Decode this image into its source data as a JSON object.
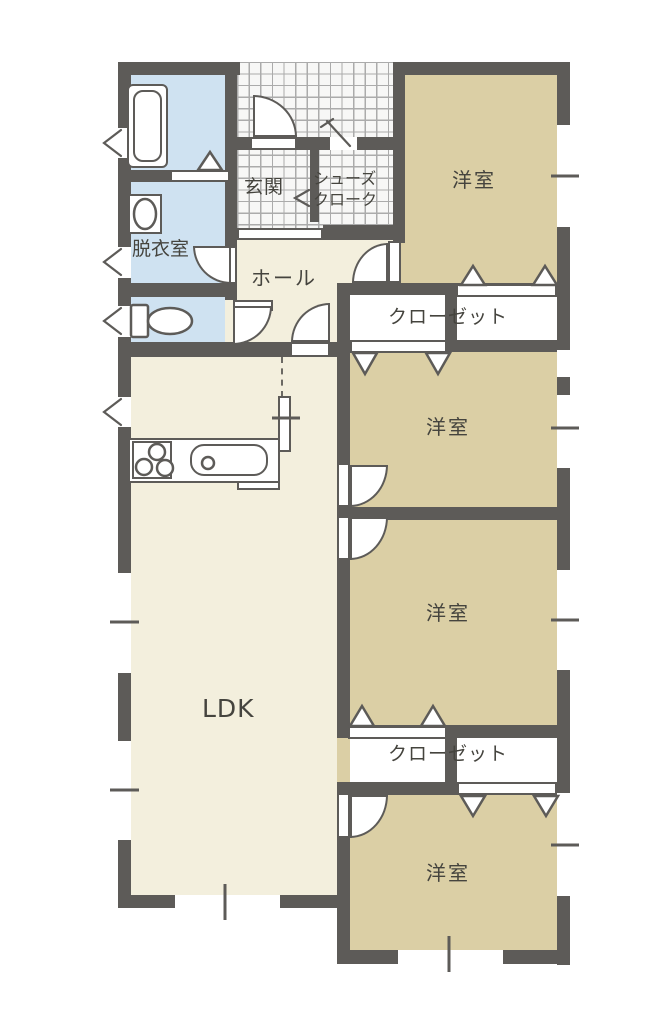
{
  "floorplan": {
    "rooms": {
      "bedroom_top": "洋室",
      "bedroom_mid_upper": "洋室",
      "bedroom_mid_lower": "洋室",
      "bedroom_bottom": "洋室",
      "ldk": "LDK",
      "hall": "ホール",
      "entrance": "玄関",
      "shoe_closet_line1": "シューズ",
      "shoe_closet_line2": "クローク",
      "dressing_room": "脱衣室",
      "closet_upper": "クローゼット",
      "closet_lower": "クローゼット"
    },
    "colors": {
      "wall": "#5d5b58",
      "bedroom_floor": "#dbcfa5",
      "living_floor": "#f3efdd",
      "wet_area_floor": "#cfe2f1",
      "tile_floor": "#f7f7f6",
      "tile_line": "#ababab",
      "text": "#45443e"
    },
    "fixtures": [
      "bathtub-icon",
      "washbasin-icon",
      "toilet-icon",
      "gas-stove-icon",
      "kitchen-sink-icon",
      "door-swing-icon",
      "bifold-door-icon",
      "window-icon",
      "sliding-door-icon",
      "awning-window-icon"
    ]
  }
}
